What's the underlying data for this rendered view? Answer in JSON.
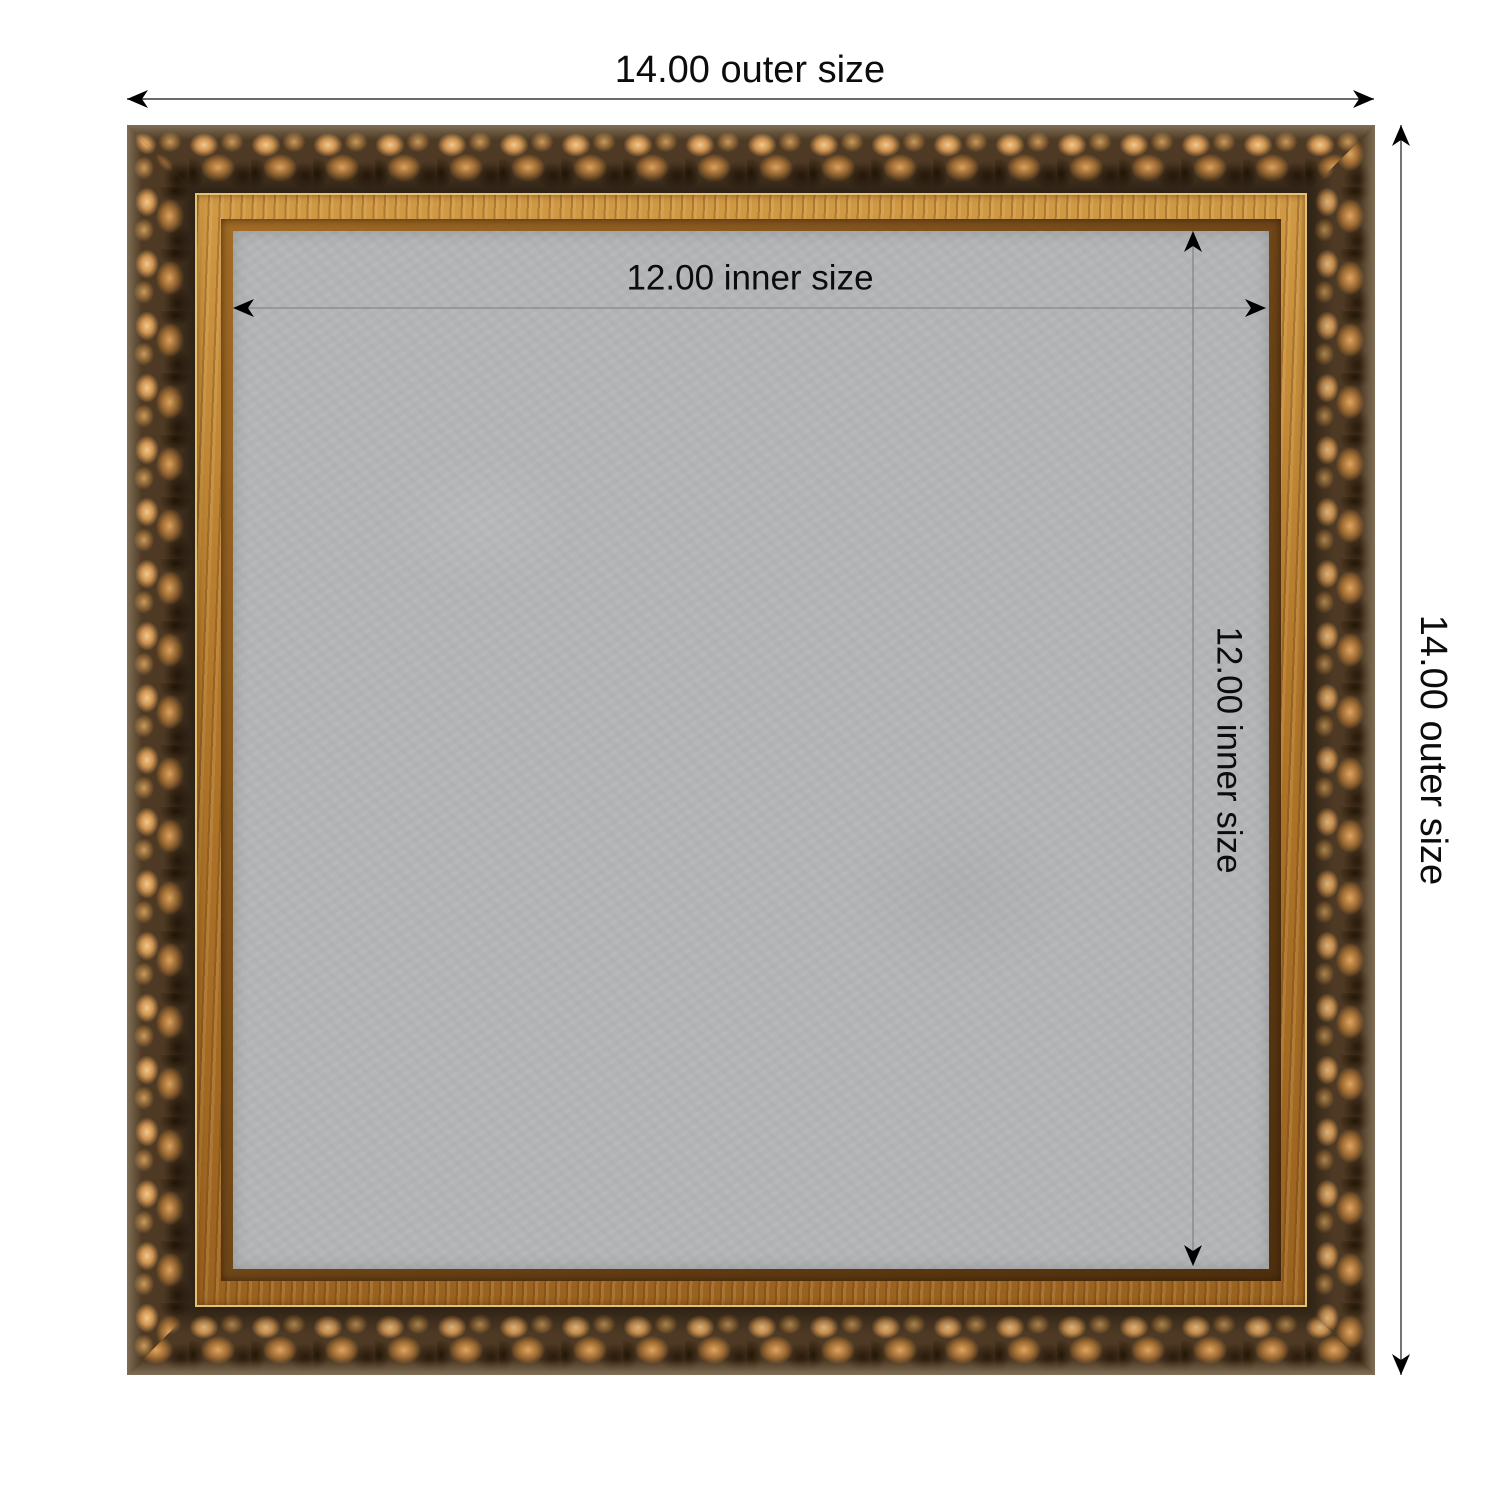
{
  "diagram": {
    "type": "product-frame-dimension-diagram",
    "background": "#ffffff"
  },
  "dimensions": {
    "outer_width": {
      "label": "14.00 outer size",
      "value": "14.00"
    },
    "outer_height": {
      "label": "14.00 outer size",
      "value": "14.00"
    },
    "inner_width": {
      "label": "12.00 inner size",
      "value": "12.00"
    },
    "inner_height": {
      "label": "12.00 inner size",
      "value": "12.00"
    }
  },
  "frame": {
    "description": "ornate antique gold scroll picture frame with gray backing",
    "colors": {
      "ornate_bronze_base": "#4e3a24",
      "copper_highlight": "#f1c98f",
      "gold_band": "#b0762a",
      "gold_edge_highlight": "#e6c172",
      "backing_gray": "#b2b4b6",
      "outer_dimension_line": "#3a3a3a",
      "inner_dimension_line": "#7d7d7d",
      "arrow": "#000000",
      "label_text": "#0c0c0c"
    }
  }
}
